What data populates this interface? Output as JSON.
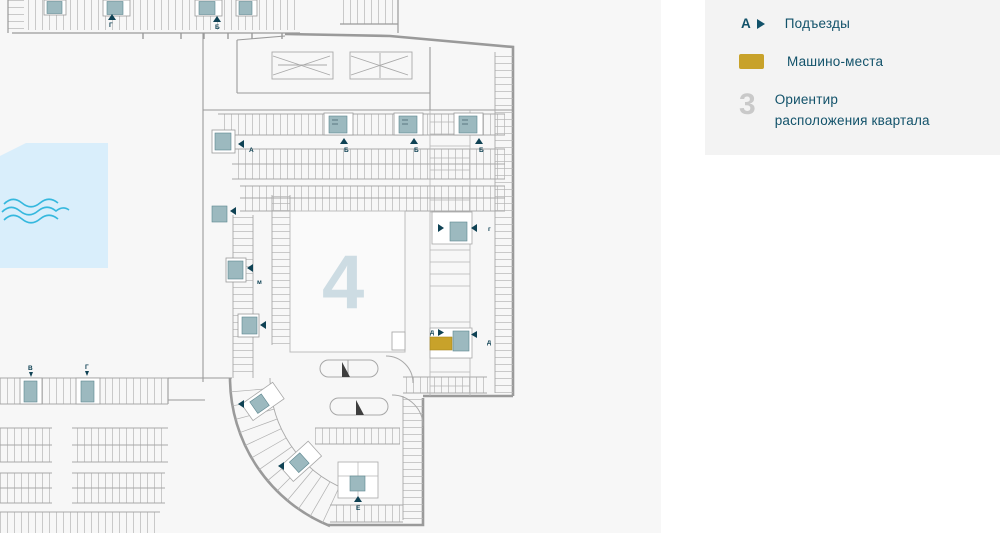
{
  "legend": {
    "entrance": {
      "symbol": "А",
      "label": "Подъезды"
    },
    "parking": {
      "label": "Машино-места",
      "color": "#c8a22a"
    },
    "district": {
      "symbol": "3",
      "label_line1": "Ориентир",
      "label_line2": "расположения квартала"
    }
  },
  "map": {
    "quarter_number": "4",
    "letters": {
      "top_strip_g": "Г",
      "top_strip_b": "Б",
      "main_a": "А",
      "main_b1": "Б",
      "main_b2": "Б",
      "main_b3": "Б",
      "right_g": "г",
      "right_d_label": "д",
      "right_d": "д",
      "left_m": "м",
      "bottom_v": "В",
      "bottom_g": "Г",
      "bottom_e": "Е"
    },
    "colors": {
      "water": "#d9eefb",
      "wave": "#35b8de",
      "core": "#9cb9bf",
      "accent": "#0f4254",
      "parking_highlight": "#c8a22a",
      "quarter_digit": "#cddce3",
      "wall": "#9a9a9a"
    }
  }
}
